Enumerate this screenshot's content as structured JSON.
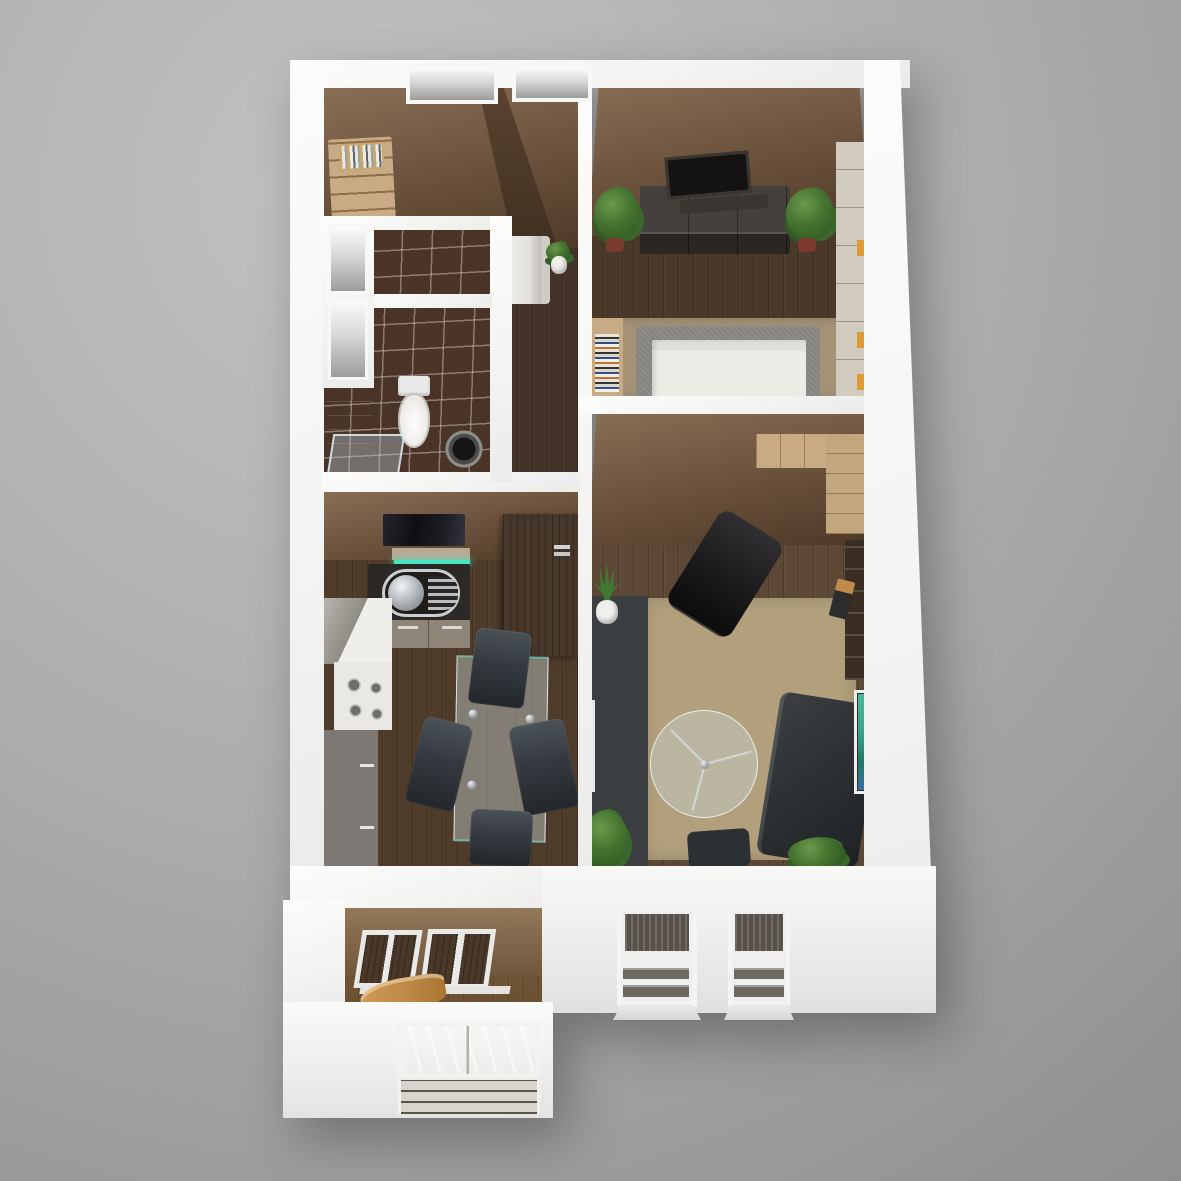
{
  "scene": {
    "description": "photorealistic 3D rendered top-down floor plan of a one-bedroom apartment with balcony",
    "view": "bird's-eye perspective, white cut walls, gray studio backdrop",
    "text_content": "none - image contains no visible text"
  },
  "palette": {
    "bg_light": "#c2c2c2",
    "bg_mid": "#adadad",
    "bg_dark": "#8f8f8f",
    "wall": "#f5f5f3",
    "face_light": "#8a6f55",
    "face_mid": "#6b523c",
    "face_dark": "#4c3827",
    "wood_hall": "#43332a",
    "wood_kitchen": "#4f3b2a",
    "wood_bed": "#4a3829",
    "wood_living": "#5d4836",
    "wood_balcony": "#6e5335",
    "rug_living": "#b2a07c",
    "rug_bed": "#a59378",
    "tile": "#4a3428",
    "grout": "rgba(230,220,210,0.42)",
    "counter_light": "#e9e8e4",
    "counter_taupe": "#7d7873",
    "counter_dark": "#2c2825",
    "steel": "#c9ced1",
    "teal_led": "#45e6c2",
    "hood_black": "#101014",
    "door_wood": "#47372a",
    "bed_frame": "#8f8d88",
    "mattress": "#edebe6",
    "dresser": "#38342f",
    "tv_black": "#201d1b",
    "shelf_wood": "#c8ab84",
    "wardrobe_light": "#d2ccc0",
    "accent_orange": "#e09a35",
    "sofa": "#2f3336",
    "sideboard": "#3b3e41",
    "ottoman": "#2d3033",
    "lounge_black": "#1a1a1c",
    "plant": "#44732f",
    "plant_dark": "#2c531e",
    "pot_white": "#f0efec",
    "pot_red": "#7a3b2e",
    "window_glass": "#57514a",
    "slat": "#6e6960",
    "sill": "#e4e3df",
    "art_teal": "#36a68c",
    "tan_chair": "#c08a4a",
    "balcony_wall": "#85694e",
    "glass_table": "rgba(196,208,206,0.45)",
    "glass_edge": "rgba(240,250,248,0.85)"
  },
  "apartment": {
    "rooms": [
      {
        "id": "storage",
        "items": [
          {
            "name": "shelving-unit",
            "count": 1
          }
        ]
      },
      {
        "id": "hallway",
        "items": [
          {
            "name": "bench",
            "count": 1
          },
          {
            "name": "potted-plant",
            "count": 1
          }
        ]
      },
      {
        "id": "wc",
        "items": []
      },
      {
        "id": "bathroom",
        "items": [
          {
            "name": "vanity-cabinet",
            "count": 1
          },
          {
            "name": "toilet",
            "count": 1
          },
          {
            "name": "washing-machine",
            "count": 1
          },
          {
            "name": "shower-screen",
            "count": 1
          }
        ]
      },
      {
        "id": "kitchen-dining",
        "items": [
          {
            "name": "cooker-hood",
            "count": 1
          },
          {
            "name": "led-shelf",
            "count": 1
          },
          {
            "name": "sink-unit",
            "count": 1
          },
          {
            "name": "drawer-unit",
            "count": 1
          },
          {
            "name": "cooktop",
            "count": 1
          },
          {
            "name": "counter-run",
            "count": 1
          },
          {
            "name": "tall-cabinet",
            "count": 1
          },
          {
            "name": "glass-dining-table",
            "count": 1
          },
          {
            "name": "dining-chair",
            "count": 4
          },
          {
            "name": "open-door-leaf",
            "count": 1
          }
        ],
        "accent": "teal LED strip under shelf"
      },
      {
        "id": "bedroom",
        "items": [
          {
            "name": "tv",
            "count": 1
          },
          {
            "name": "media-dresser",
            "count": 1
          },
          {
            "name": "potted-plant",
            "count": 2
          },
          {
            "name": "book-rack",
            "count": 1
          },
          {
            "name": "double-bed",
            "count": 1
          },
          {
            "name": "wardrobe-panels",
            "count": 1
          },
          {
            "name": "area-rug",
            "count": 1
          }
        ]
      },
      {
        "id": "living-room",
        "items": [
          {
            "name": "corner-wardrobe",
            "count": 1
          },
          {
            "name": "lounge-chair",
            "count": 1
          },
          {
            "name": "east-shelf",
            "count": 1
          },
          {
            "name": "floor-lamp",
            "count": 1
          },
          {
            "name": "sideboard-desk",
            "count": 1
          },
          {
            "name": "potted-plant",
            "count": 3
          },
          {
            "name": "round-glass-table",
            "count": 1
          },
          {
            "name": "sofa",
            "count": 1
          },
          {
            "name": "ottoman",
            "count": 1
          },
          {
            "name": "wall-art",
            "count": 1
          },
          {
            "name": "area-rug",
            "count": 1
          }
        ]
      },
      {
        "id": "balcony",
        "items": [
          {
            "name": "glazed-windows",
            "count": 2
          },
          {
            "name": "lounger",
            "count": 1
          }
        ]
      }
    ],
    "exterior_features": [
      {
        "name": "north-wall-opening",
        "count": 2
      },
      {
        "name": "south-window-with-railing",
        "count": 2
      },
      {
        "name": "balcony-window-with-railing",
        "count": 1
      },
      {
        "name": "interior-wall-niche",
        "count": 2
      }
    ]
  }
}
